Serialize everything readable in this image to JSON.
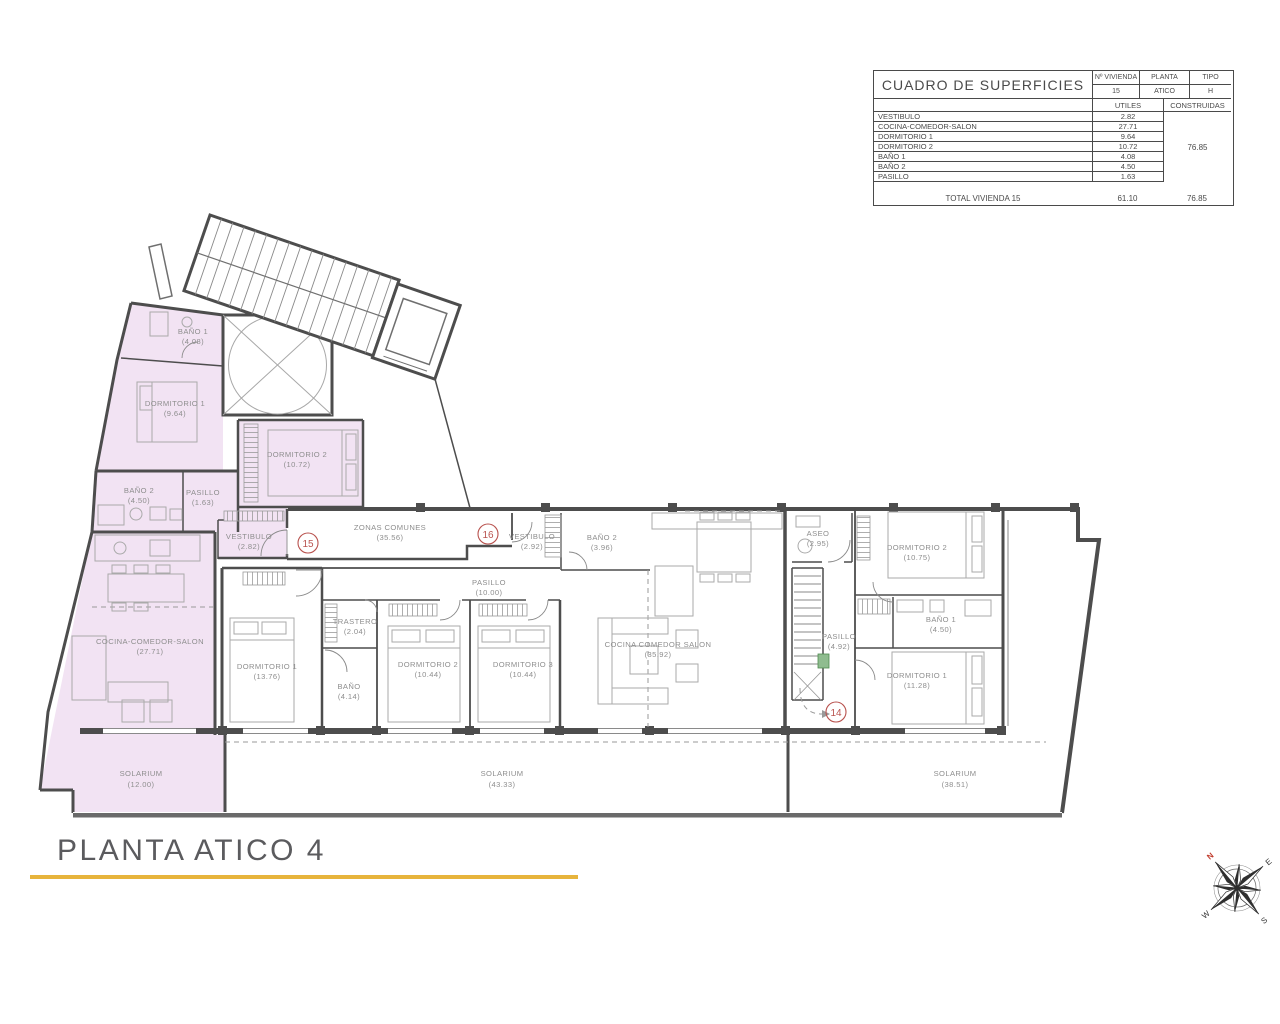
{
  "page": {
    "title": "PLANTA ATICO 4"
  },
  "table": {
    "title": "CUADRO DE SUPERFICIES",
    "col_vivienda": "Nº VIVIENDA",
    "col_planta": "PLANTA",
    "col_tipo": "TIPO",
    "vivienda": "15",
    "planta": "ATICO",
    "tipo": "H",
    "col_utiles": "UTILES",
    "col_construidas": "CONSTRUIDAS",
    "rows": [
      {
        "label": "VESTIBULO",
        "utiles": "2.82"
      },
      {
        "label": "COCINA-COMEDOR-SALON",
        "utiles": "27.71"
      },
      {
        "label": "DORMITORIO 1",
        "utiles": "9.64"
      },
      {
        "label": "DORMITORIO 2",
        "utiles": "10.72"
      },
      {
        "label": "BAÑO 1",
        "utiles": "4.08"
      },
      {
        "label": "BAÑO 2",
        "utiles": "4.50"
      },
      {
        "label": "PASILLO",
        "utiles": "1.63"
      }
    ],
    "construidas_total": "76.85",
    "total_label": "TOTAL VIVIENDA 15",
    "total_utiles": "61.10",
    "total_construidas": "76.85"
  },
  "plan": {
    "units": [
      "15",
      "16",
      "14"
    ],
    "rooms": [
      {
        "name": "BAÑO 1",
        "area": "(4.08)"
      },
      {
        "name": "DORMITORIO 1",
        "area": "(9.64)"
      },
      {
        "name": "DORMITORIO 2",
        "area": "(10.72)"
      },
      {
        "name": "BAÑO 2",
        "area": "(4.50)"
      },
      {
        "name": "PASILLO",
        "area": "(1.63)"
      },
      {
        "name": "VESTIBULO",
        "area": "(2.82)"
      },
      {
        "name": "COCINA-COMEDOR-SALON",
        "area": "(27.71)"
      },
      {
        "name": "SOLARIUM",
        "area": "(12.00)"
      },
      {
        "name": "ZONAS COMUNES",
        "area": "(35.56)"
      },
      {
        "name": "VESTIBULO",
        "area": "(2.92)"
      },
      {
        "name": "BAÑO 2",
        "area": "(3.96)"
      },
      {
        "name": "PASILLO",
        "area": "(10.00)"
      },
      {
        "name": "TRASTERO",
        "area": "(2.04)"
      },
      {
        "name": "DORMITORIO 1",
        "area": "(13.76)"
      },
      {
        "name": "BAÑO",
        "area": "(4.14)"
      },
      {
        "name": "DORMITORIO 2",
        "area": "(10.44)"
      },
      {
        "name": "DORMITORIO 3",
        "area": "(10.44)"
      },
      {
        "name": "COCINA COMEDOR SALON",
        "area": "(35.92)"
      },
      {
        "name": "SOLARIUM",
        "area": "(43.33)"
      },
      {
        "name": "ASEO",
        "area": "(2.95)"
      },
      {
        "name": "DORMITORIO 2",
        "area": "(10.75)"
      },
      {
        "name": "BAÑO 1",
        "area": "(4.50)"
      },
      {
        "name": "PASILLO",
        "area": "(4.92)"
      },
      {
        "name": "DORMITORIO 1",
        "area": "(11.28)"
      },
      {
        "name": "SOLARIUM",
        "area": "(38.51)"
      }
    ]
  },
  "compass": {
    "n": "N",
    "e": "E",
    "s": "S",
    "w": "W"
  }
}
